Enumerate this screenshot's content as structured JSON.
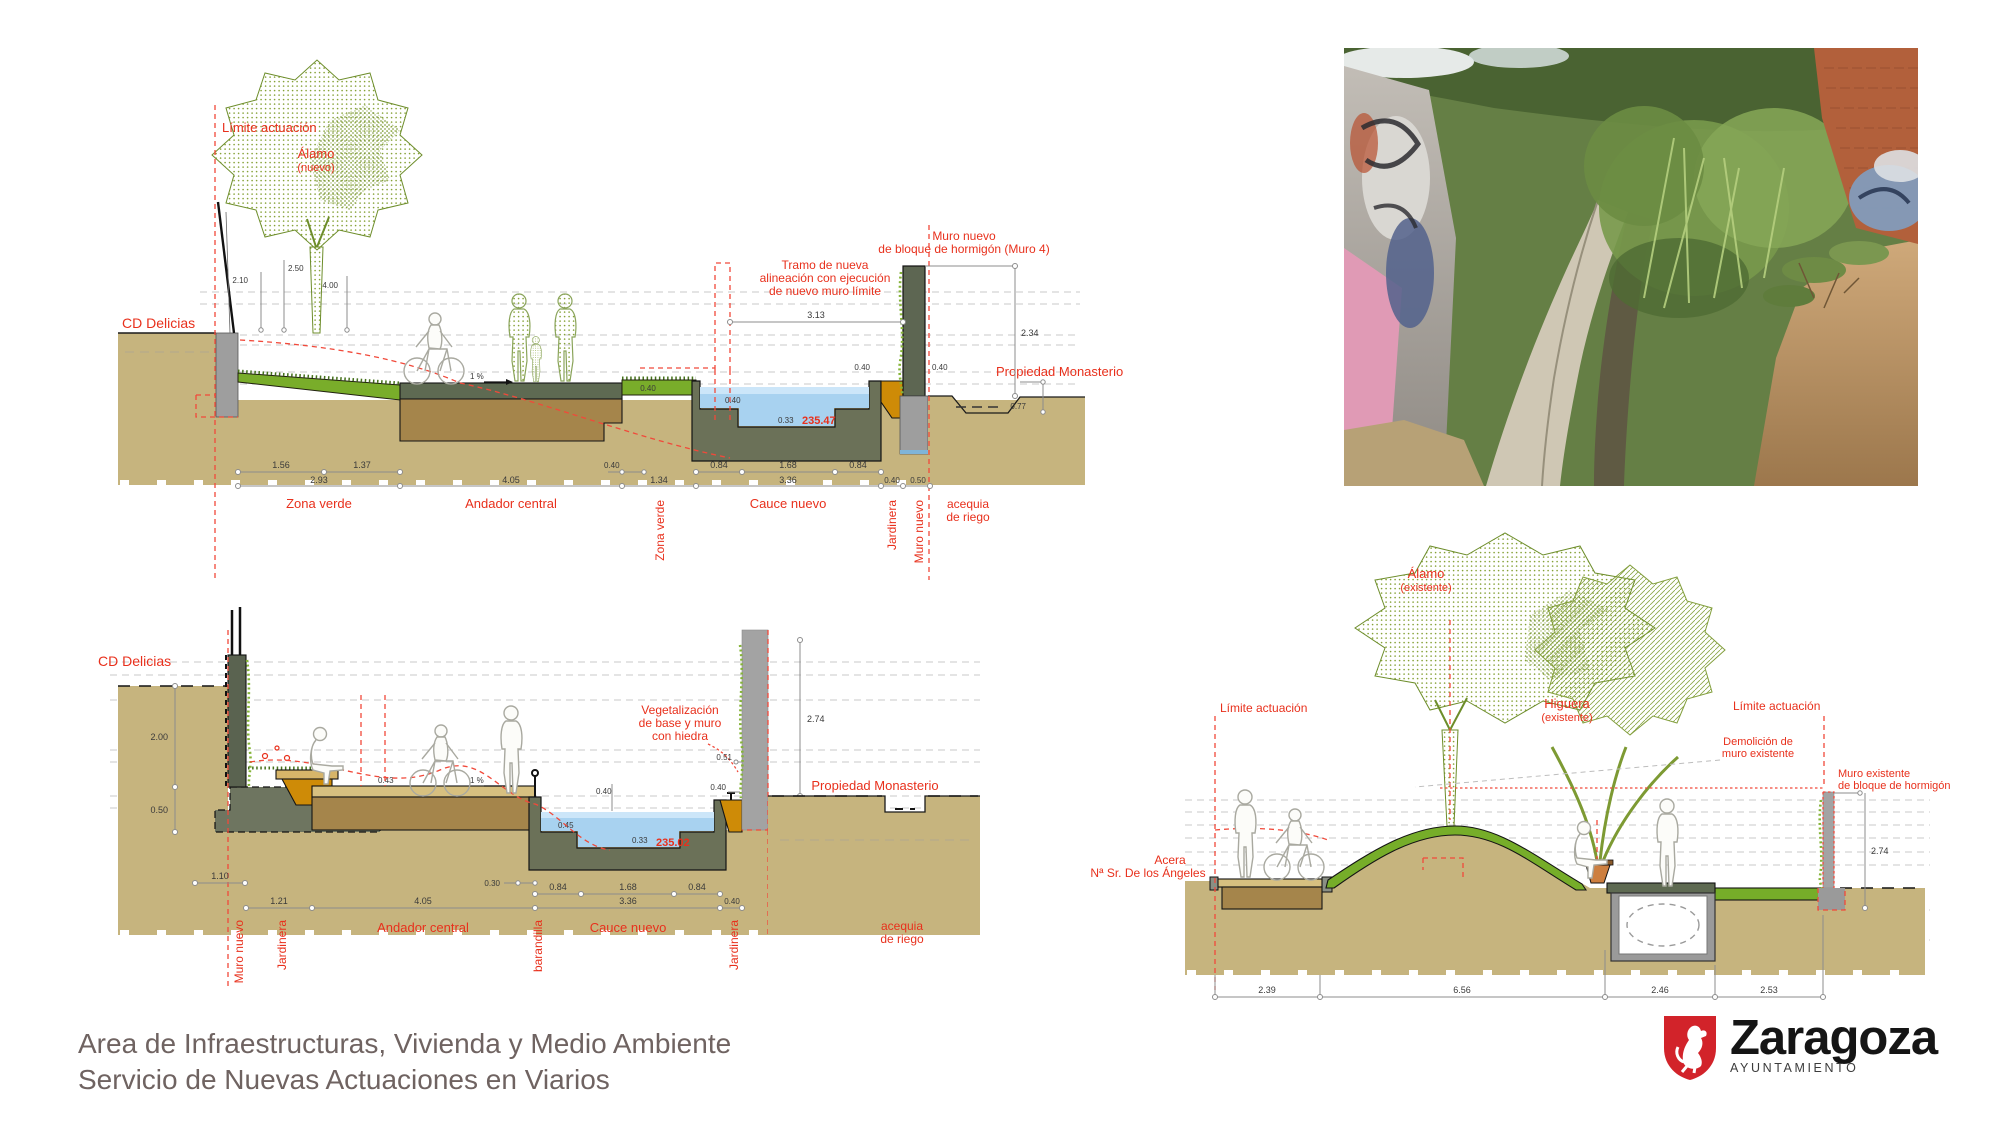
{
  "colors": {
    "accent_red": "#e8301c",
    "ground_tan": "#c6b47e",
    "subbase_brown": "#a5854b",
    "concrete_olive": "#6b7158",
    "water_blue": "#a8d2f0",
    "green_zone": "#79ad2a",
    "planter_orange": "#ce8b07",
    "wall_gray": "#a3a3a3",
    "logo_red": "#d2232a"
  },
  "s1": {
    "limite": "Límite actuación",
    "alamo": "Álamo",
    "alamo_sub": "(nuevo)",
    "cd": "CD Delicias",
    "tramo1": "Tramo de nueva",
    "tramo2": "alineación con ejecución",
    "tramo3": "de nuevo muro límite",
    "muro1": "Muro nuevo",
    "muro2": "de bloque de hormigón (Muro 4)",
    "prop": "Propiedad Monasterio",
    "slope": "1 %",
    "elev": "235.47",
    "zona": "Zona verde",
    "andador": "Andador central",
    "cauce": "Cauce nuevo",
    "zona_v": "Zona verde",
    "jard_v": "Jardinera",
    "muro_v": "Muro nuevo",
    "aceq1": "acequia",
    "aceq2": "de riego",
    "d210": "2.10",
    "d250": "2.50",
    "d400": "4.00",
    "d313": "3.13",
    "d234": "2.34",
    "d040a": "0.40",
    "d040b": "0.40",
    "d077": "0.77",
    "d156": "1.56",
    "d137": "1.37",
    "d293": "2.93",
    "d405": "4.05",
    "d040c": "0.40",
    "d134": "1.34",
    "d084a": "0.84",
    "d168": "1.68",
    "d084b": "0.84",
    "d336": "3.36",
    "d040d": "0.40",
    "d050": "0.50",
    "d040e": "0.40",
    "d040f": "0.40",
    "d033": "0.33"
  },
  "s2": {
    "cd": "CD Delicias",
    "veg1": "Vegetalización",
    "veg2": "de base y muro",
    "veg3": "con hiedra",
    "prop": "Propiedad Monasterio",
    "slope": "1 %",
    "elev": "235.02",
    "andador": "Andador central",
    "cauce": "Cauce nuevo",
    "muro_v": "Muro nuevo",
    "jard_v1": "Jardinera",
    "baran_v": "barandilla",
    "jard_v2": "Jardinera",
    "aceq1": "acequia",
    "aceq2": "de riego",
    "d200": "2.00",
    "d050": "0.50",
    "d043": "0.43",
    "d051": "0.51",
    "d040a": "0.40",
    "d274": "2.74",
    "d040b": "0.40",
    "d045": "0.45",
    "d033": "0.33",
    "d110": "1.10",
    "d030": "0.30",
    "d084a": "0.84",
    "d168": "1.68",
    "d084b": "0.84",
    "d121": "1.21",
    "d405": "4.05",
    "d336": "3.36",
    "d040c": "0.40"
  },
  "s3": {
    "alamo": "Álamo",
    "alamo_sub": "(existente)",
    "higuera": "Higuera",
    "higuera_sub": "(existente)",
    "limite_left": "Límite actuación",
    "limite_right": "Límite actuación",
    "demo1": "Demolición de",
    "demo2": "muro existente",
    "muroex1": "Muro existente",
    "muroex2": "de bloque de hormigón",
    "acera1": "Acera",
    "acera2": "Nª Sr. De los Ángeles",
    "d239": "2.39",
    "d656": "6.56",
    "d246": "2.46",
    "d253": "2.53",
    "d274": "2.74"
  },
  "footer": {
    "line1": "Area de Infraestructuras, Vivienda y Medio Ambiente",
    "line2": "Servicio de Nuevas Actuaciones en Viarios"
  },
  "logo": {
    "title": "Zaragoza",
    "subtitle": "AYUNTAMIENTO"
  }
}
